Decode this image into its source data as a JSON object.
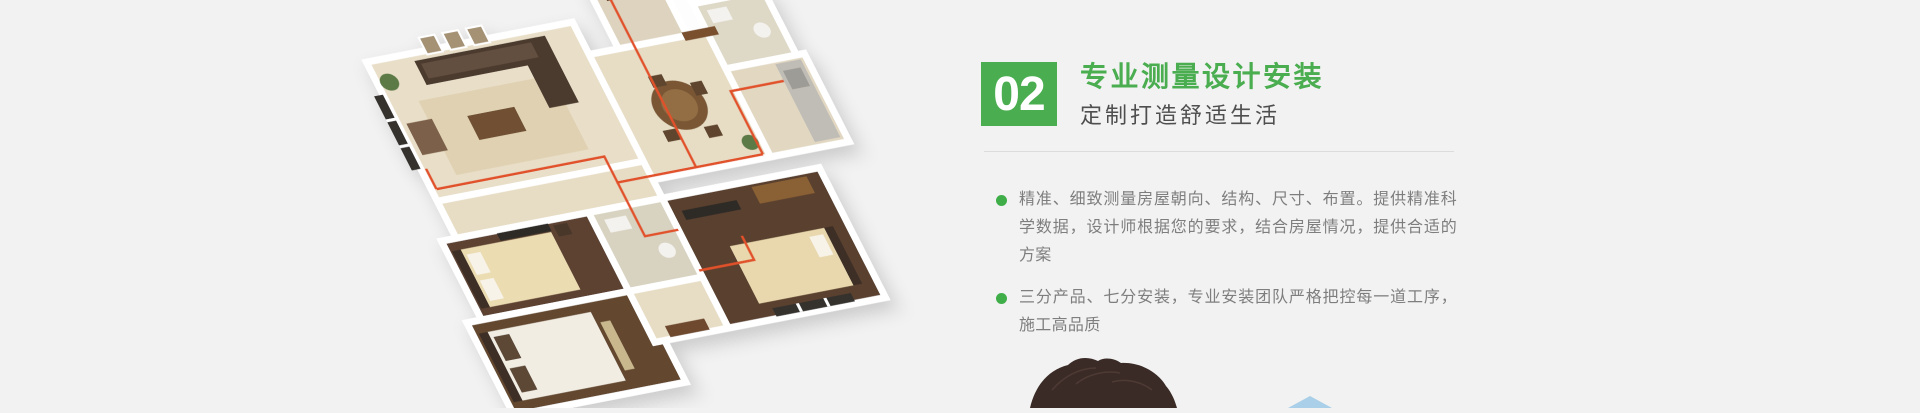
{
  "page": {
    "background_color": "#f2f2f2"
  },
  "section": {
    "step_number": "02",
    "title": "专业测量设计安装",
    "subtitle": "定制打造舒适生活",
    "points": [
      {
        "text": "精准、细致测量房屋朝向、结构、尺寸、布置。提供精准科学数据，设计师根据您的要求，结合房屋情况，提供合适的方案"
      },
      {
        "text": "三分产品、七分安装，专业安装团队严格把控每一道工序，施工高品质"
      }
    ],
    "accent_color": "#4aad4f",
    "bullet_color": "#3fae49",
    "body_text_color": "#7e7e7e",
    "subtitle_color": "#4f4f4f",
    "divider_color": "#dcdcdc"
  },
  "illustration": {
    "kind": "isometric-apartment-floorplan",
    "pipe_color": "#e1512a",
    "wall_color": "#ffffff",
    "tile_floor_color": "#e7dcc4",
    "wood_floor_color": "#5d4231"
  },
  "decor": {
    "person_hair_color": "#3a2b27",
    "triangle_color": "#aacfe8"
  }
}
